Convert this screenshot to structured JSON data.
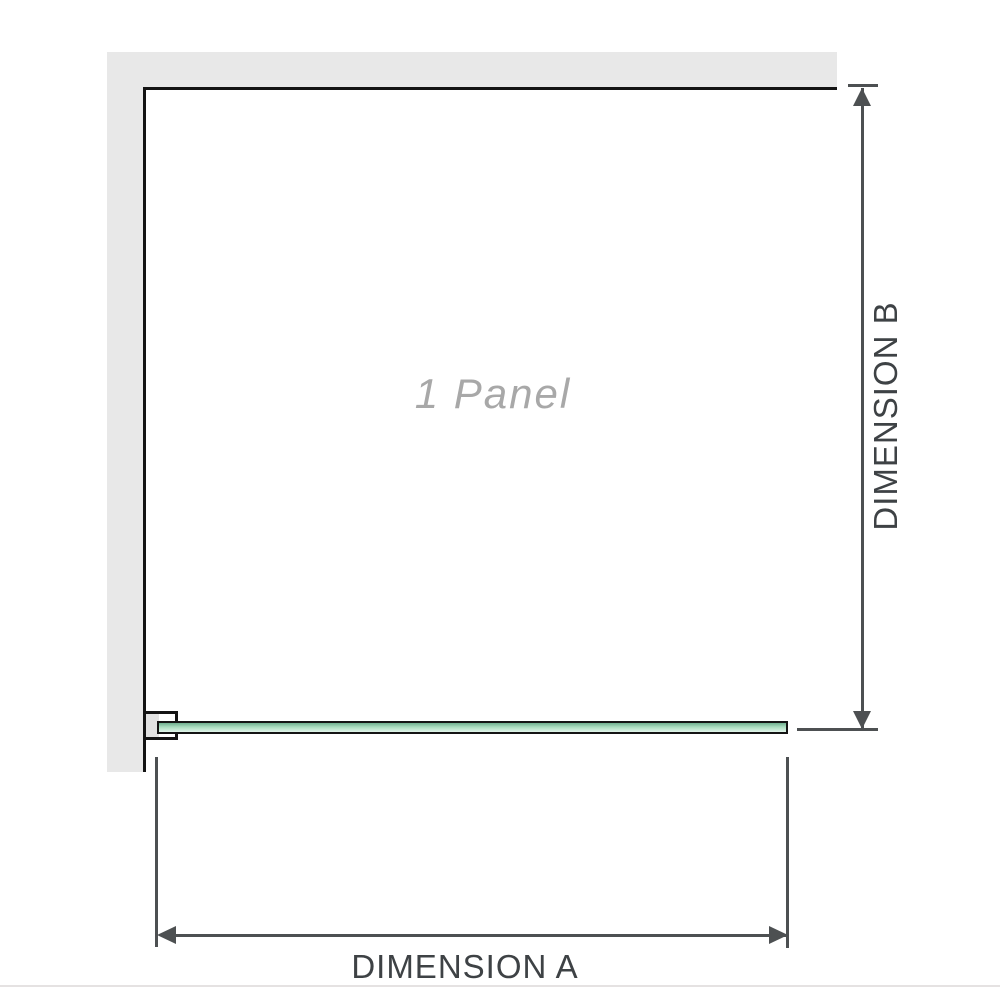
{
  "diagram": {
    "panel_label": "1 Panel",
    "dimension_a": {
      "label": "DIMENSION A"
    },
    "dimension_b": {
      "label": "DIMENSION B"
    },
    "colors": {
      "wall": "#e8e8e8",
      "outline": "#141414",
      "dimension_line": "#4d5052",
      "label_text": "#3e4245",
      "panel_text": "#a8a8a8",
      "glass_top": "#6fae8e",
      "glass_mid": "#a9dcbe",
      "glass_bottom": "#e2f4ea",
      "bracket_fill": "#e2e2e2",
      "page_border": "#e5e2e2"
    }
  }
}
